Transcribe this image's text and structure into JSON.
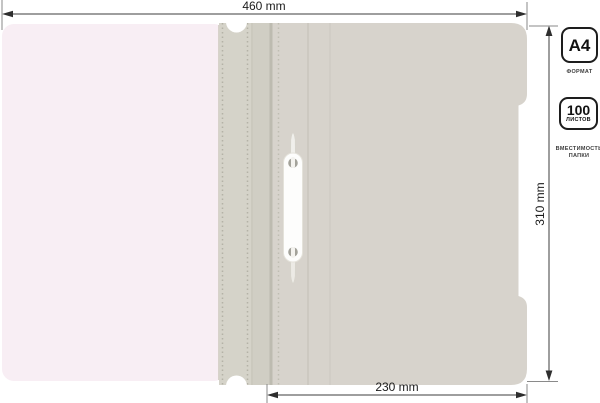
{
  "dimensions": {
    "total_width": "460 mm",
    "total_height": "310 mm",
    "front_cover_width": "230 mm"
  },
  "badges": {
    "format": {
      "value": "A4",
      "caption": "ФОРМАТ"
    },
    "capacity": {
      "value": "100",
      "unit": "ЛИСТОВ",
      "caption_line1": "ВМЕСТИМОСТЬ",
      "caption_line2": "ПАПКИ"
    }
  },
  "colors": {
    "background": "#ffffff",
    "back_page": "#f8eef4",
    "spine": "#d5d3c9",
    "spine_inner": "#d0cec4",
    "cover": "#d7d3cc",
    "fastener": "#fdfdfc",
    "dimension_line": "#3c3c3c",
    "badge_border": "#1d1d1d"
  }
}
